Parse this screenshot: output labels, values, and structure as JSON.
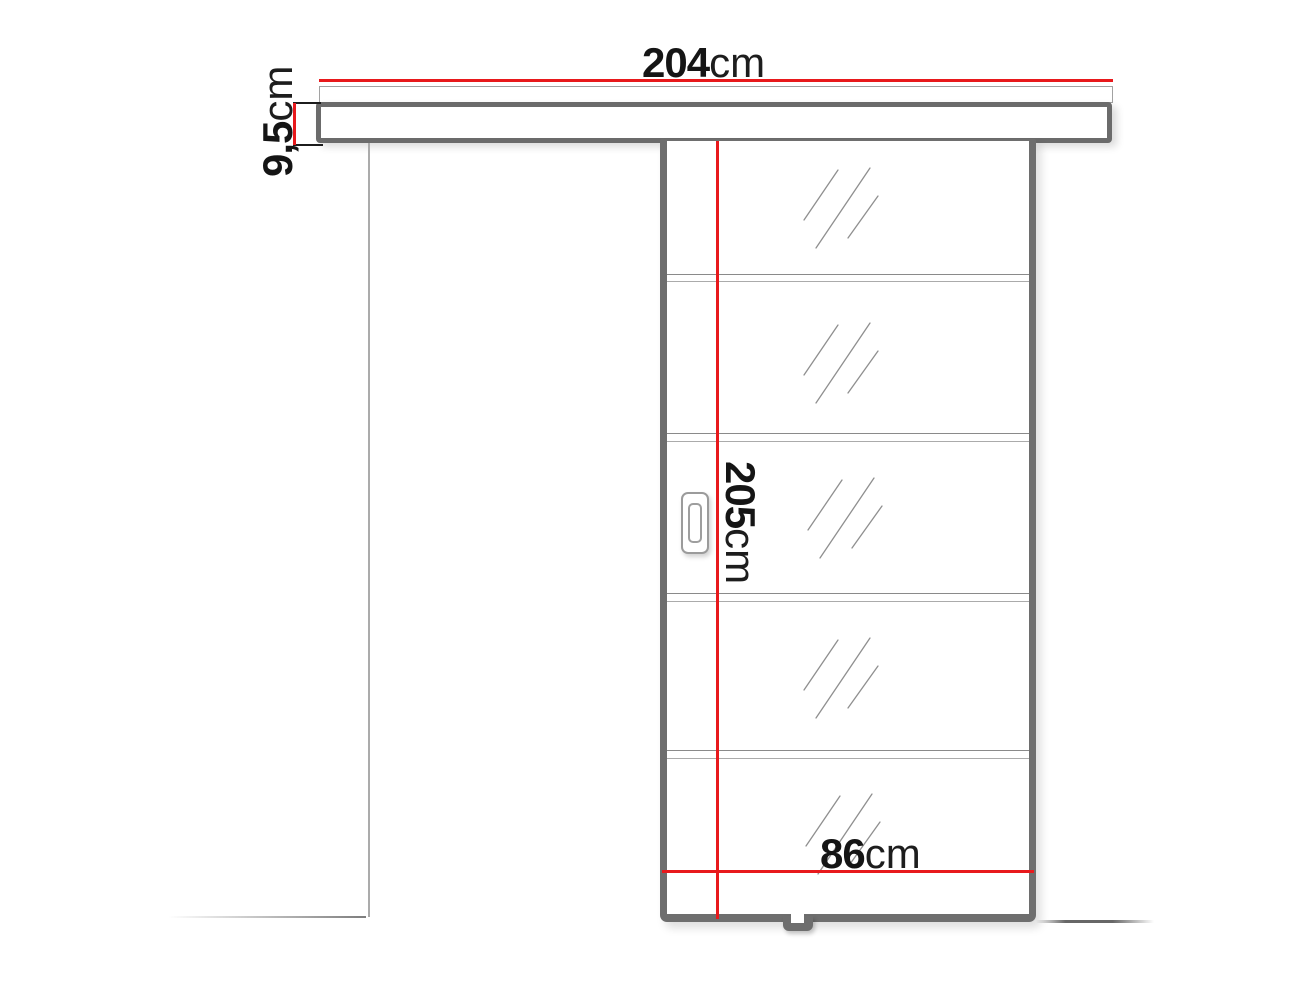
{
  "diagram": {
    "type": "sliding-door-dimension-diagram",
    "dimensions": {
      "rail_width": {
        "number": "204",
        "unit": "cm"
      },
      "rail_height": {
        "number": "9,5",
        "unit": "cm"
      },
      "door_height": {
        "number": "205",
        "unit": "cm"
      },
      "door_width": {
        "number": "86",
        "unit": "cm"
      }
    },
    "door": {
      "glass_sections": 5,
      "has_handle": true,
      "has_floor_guide": true
    },
    "colors": {
      "dimension_line": "#e8191c",
      "frame": "#6e6e6e",
      "thin_line": "#a8a8a8",
      "text": "#151515",
      "background": "#ffffff"
    }
  }
}
